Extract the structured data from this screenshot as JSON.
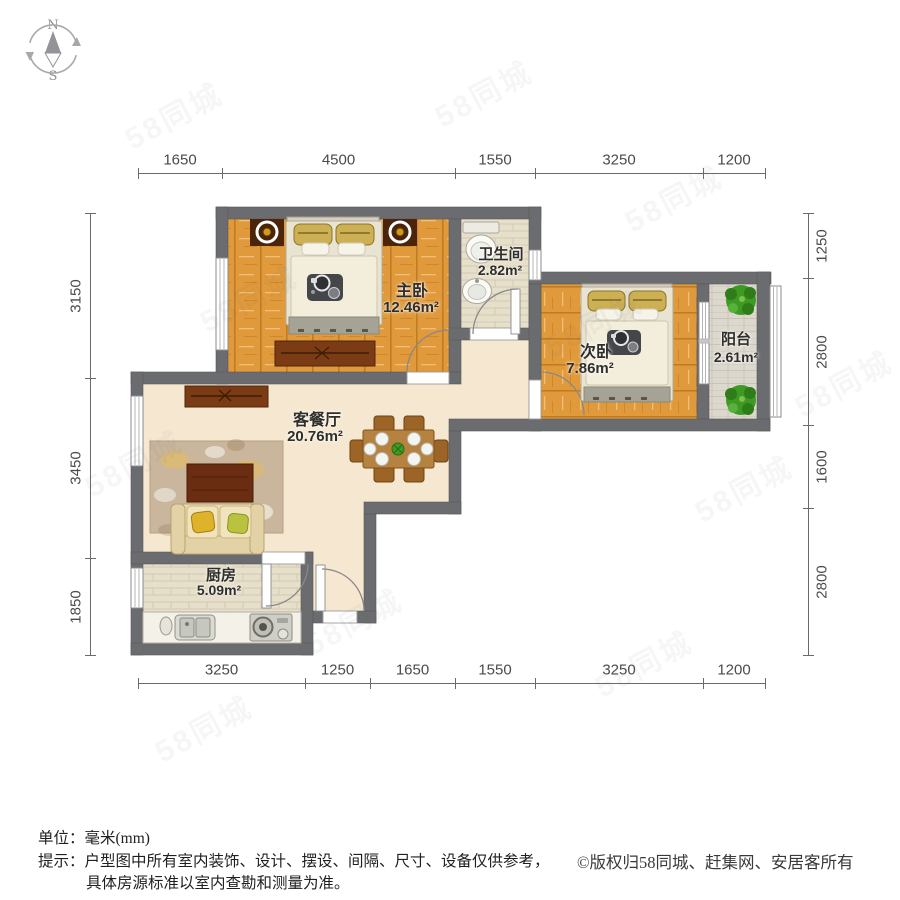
{
  "compass": {
    "north": "N",
    "south": "S"
  },
  "rooms": {
    "master": {
      "name": "主卧",
      "area": "12.46m²"
    },
    "bath": {
      "name": "卫生间",
      "area": "2.82m²"
    },
    "second": {
      "name": "次卧",
      "area": "7.86m²"
    },
    "balcony": {
      "name": "阳台",
      "area": "2.61m²"
    },
    "living": {
      "name": "客餐厅",
      "area": "20.76m²"
    },
    "kitchen": {
      "name": "厨房",
      "area": "5.09m²"
    }
  },
  "dimensions": {
    "top": [
      "1650",
      "4500",
      "1550",
      "3250",
      "1200"
    ],
    "bottom": [
      "3250",
      "1250",
      "1650",
      "1550",
      "3250",
      "1200"
    ],
    "left": [
      "3150",
      "3450",
      "1850"
    ],
    "right": [
      "1250",
      "2800",
      "1600",
      "2800"
    ]
  },
  "footer": {
    "unit_label": "单位：毫米(mm)",
    "tip_line1": "提示：户型图中所有室内装饰、设计、摆设、间隔、尺寸、设备仅供参考，",
    "tip_line2": "具体房源标准以室内查勘和测量为准。",
    "copyright": "©版权归58同城、赶集网、安居客所有"
  },
  "watermark": {
    "text": "58同城"
  },
  "colors": {
    "wall": "#6b6c6f",
    "wood": "#e19a3b",
    "living_floor": "#f6e8d0",
    "tile_floor": "#e6dfc9",
    "balcony_floor": "#dcd8cd",
    "label_text": "#2f2e2a",
    "dim_text": "#4b4b4b"
  }
}
